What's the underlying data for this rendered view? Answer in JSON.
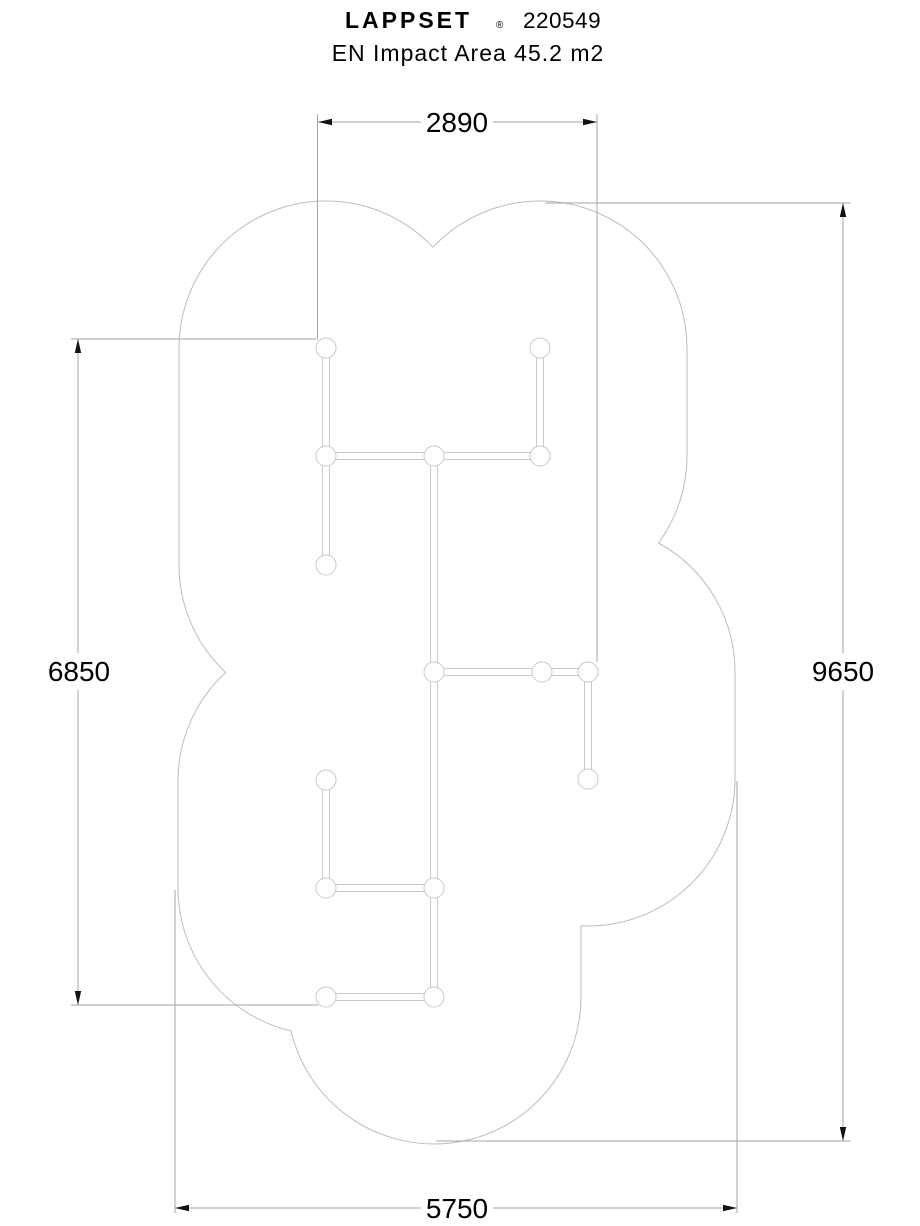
{
  "header": {
    "brand": "LAPPSET",
    "registered_mark": "®",
    "product_code": "220549",
    "subtitle": "EN Impact Area 45.2 m2"
  },
  "dimensions": {
    "top_mm": "2890",
    "left_mm": "6850",
    "right_mm": "9650",
    "bottom_mm": "5750"
  },
  "colors": {
    "dim": "#a6a6a6",
    "outline": "#bdbdbd",
    "structure": "#c9c9c9",
    "text": "#000000",
    "arrow": "#111111",
    "bg": "#ffffff"
  }
}
